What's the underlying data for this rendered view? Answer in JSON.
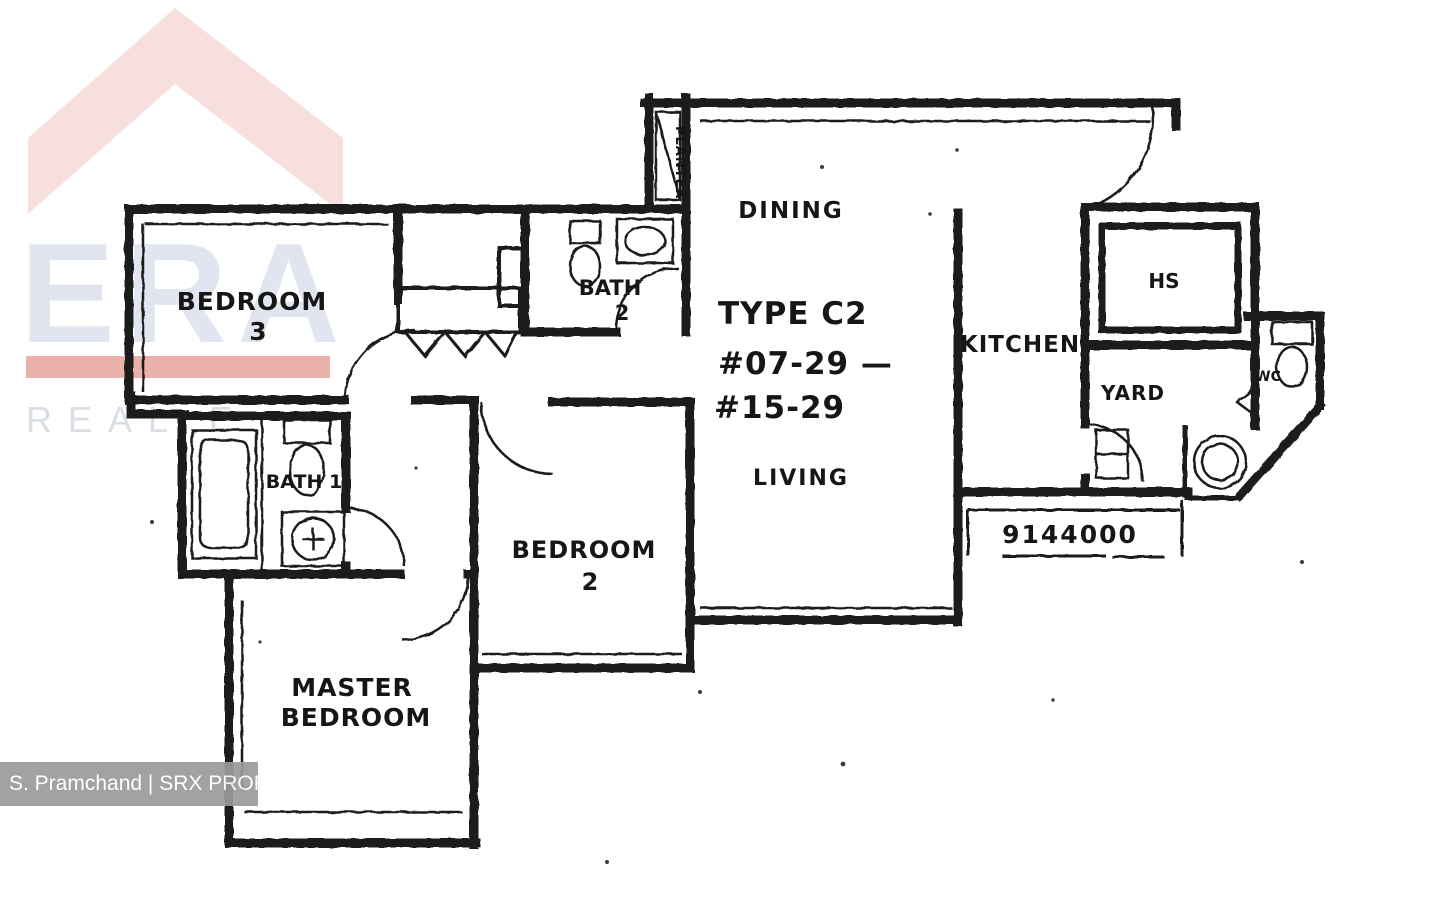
{
  "watermark": {
    "brand": "ERA",
    "tagline": "REAL E",
    "colors": {
      "roof": "#f6dfdd",
      "letters": "#e1e5ef",
      "bar": "#e9b1a9",
      "tagline": "#d9dde4"
    }
  },
  "credit": {
    "text": "S. Pramchand | SRX PROPERTY"
  },
  "plan": {
    "type": "TYPE C2",
    "units_line1": "#07-29 —",
    "units_line2": "#15-29",
    "plan_no": "9144000",
    "ink": "#1b1b1b",
    "labels": {
      "bedroom3_line1": "BEDROOM",
      "bedroom3_line2": "3",
      "bath2_line1": "BATH",
      "bath2_line2": "2",
      "planter": "PLANTER",
      "dining": "DINING",
      "living": "LIVING",
      "kitchen": "KITCHEN",
      "hs": "HS",
      "yard": "YARD",
      "wc": "WC",
      "bedroom2_line1": "BEDROOM",
      "bedroom2_line2": "2",
      "bath1": "BATH 1",
      "master_line1": "MASTER",
      "master_line2": "BEDROOM"
    }
  }
}
